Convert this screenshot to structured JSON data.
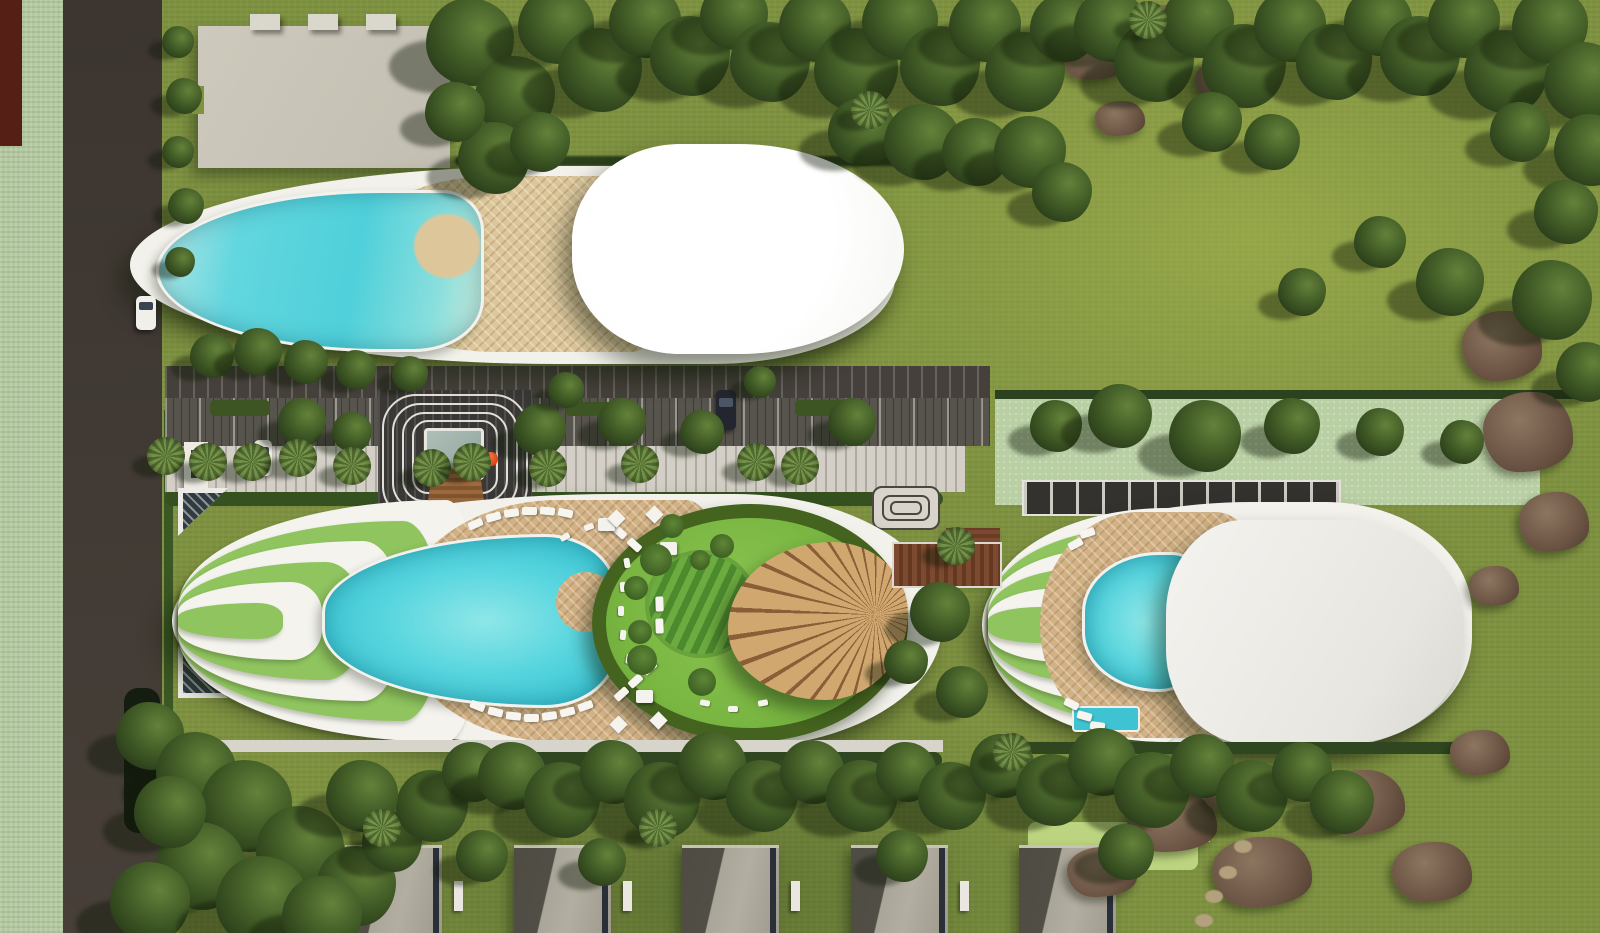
{
  "palette": {
    "lawn": "#7e9240",
    "lawn_light": "#9fae50",
    "paddock": "#b9cfa4",
    "greenbelt": "#b4c9a1",
    "road": "#3f3833",
    "maroon": "#551f16",
    "pool_water": "#4fd0da",
    "pool_deep": "#2aa9bd",
    "deck_wood": "#d2b184",
    "hull_white": "#f2f1eb",
    "roof_white": "#ffffff",
    "roof_gray": "#e9e8e3",
    "beige_building": "#c8c4b7",
    "villa_roof_light": "#aca89b",
    "villa_roof_dark": "#504d45",
    "tree_dark": "#2a3d1a",
    "terrace_green": "#8fc45f",
    "canopy_wood": "#c79a60",
    "accent_ball": "#e34e1f"
  },
  "landscape": {
    "trees": [
      [
        470,
        42,
        44
      ],
      [
        515,
        96,
        40
      ],
      [
        556,
        26,
        38
      ],
      [
        600,
        70,
        42
      ],
      [
        645,
        22,
        36
      ],
      [
        690,
        56,
        40
      ],
      [
        734,
        16,
        34
      ],
      [
        770,
        62,
        40
      ],
      [
        815,
        26,
        36
      ],
      [
        856,
        70,
        42
      ],
      [
        900,
        22,
        38
      ],
      [
        940,
        66,
        40
      ],
      [
        985,
        26,
        36
      ],
      [
        1025,
        72,
        40
      ],
      [
        1064,
        28,
        34
      ],
      [
        494,
        158,
        36
      ],
      [
        540,
        142,
        30
      ],
      [
        862,
        132,
        34
      ],
      [
        922,
        142,
        38
      ],
      [
        976,
        152,
        34
      ],
      [
        1030,
        152,
        36
      ],
      [
        1062,
        192,
        30
      ],
      [
        455,
        112,
        30
      ],
      [
        1110,
        26,
        36
      ],
      [
        1154,
        62,
        40
      ],
      [
        1198,
        22,
        36
      ],
      [
        1244,
        66,
        42
      ],
      [
        1290,
        26,
        36
      ],
      [
        1334,
        62,
        38
      ],
      [
        1378,
        22,
        34
      ],
      [
        1420,
        56,
        40
      ],
      [
        1464,
        22,
        36
      ],
      [
        1506,
        72,
        42
      ],
      [
        1550,
        26,
        38
      ],
      [
        1584,
        82,
        40
      ],
      [
        1590,
        150,
        36
      ],
      [
        1566,
        212,
        32
      ],
      [
        1520,
        132,
        30
      ],
      [
        1212,
        122,
        30
      ],
      [
        1272,
        142,
        28
      ],
      [
        1450,
        282,
        34
      ],
      [
        1552,
        300,
        40
      ],
      [
        1586,
        372,
        30
      ],
      [
        1380,
        242,
        26
      ],
      [
        1302,
        292,
        24
      ],
      [
        1056,
        426,
        26
      ],
      [
        1120,
        416,
        32
      ],
      [
        1205,
        436,
        36
      ],
      [
        1292,
        426,
        28
      ],
      [
        1380,
        432,
        24
      ],
      [
        1462,
        442,
        22
      ],
      [
        302,
        422,
        24
      ],
      [
        352,
        432,
        20
      ],
      [
        540,
        430,
        26
      ],
      [
        622,
        422,
        24
      ],
      [
        702,
        432,
        22
      ],
      [
        852,
        422,
        24
      ],
      [
        566,
        390,
        18
      ],
      [
        760,
        382,
        16
      ],
      [
        178,
        42,
        16
      ],
      [
        184,
        96,
        18
      ],
      [
        178,
        152,
        16
      ],
      [
        186,
        206,
        18
      ],
      [
        180,
        262,
        15
      ],
      [
        212,
        356,
        22
      ],
      [
        258,
        352,
        24
      ],
      [
        306,
        362,
        22
      ],
      [
        356,
        370,
        20
      ],
      [
        410,
        374,
        18
      ],
      [
        940,
        612,
        30
      ],
      [
        962,
        692,
        26
      ],
      [
        906,
        662,
        22
      ],
      [
        150,
        736,
        34
      ],
      [
        196,
        772,
        40
      ],
      [
        246,
        806,
        46
      ],
      [
        300,
        850,
        44
      ],
      [
        356,
        886,
        40
      ],
      [
        200,
        866,
        44
      ],
      [
        150,
        902,
        40
      ],
      [
        262,
        902,
        46
      ],
      [
        322,
        916,
        40
      ],
      [
        170,
        812,
        36
      ],
      [
        392,
        842,
        30
      ],
      [
        432,
        806,
        36
      ],
      [
        472,
        772,
        30
      ],
      [
        362,
        796,
        36
      ],
      [
        512,
        776,
        34
      ],
      [
        562,
        800,
        38
      ],
      [
        612,
        772,
        32
      ],
      [
        662,
        800,
        38
      ],
      [
        712,
        766,
        34
      ],
      [
        762,
        796,
        36
      ],
      [
        812,
        772,
        32
      ],
      [
        862,
        796,
        36
      ],
      [
        906,
        772,
        30
      ],
      [
        952,
        796,
        34
      ],
      [
        1002,
        766,
        32
      ],
      [
        1052,
        790,
        36
      ],
      [
        1102,
        762,
        34
      ],
      [
        1152,
        790,
        38
      ],
      [
        1202,
        766,
        32
      ],
      [
        1252,
        796,
        36
      ],
      [
        1302,
        772,
        30
      ],
      [
        1342,
        802,
        32
      ],
      [
        482,
        856,
        26
      ],
      [
        602,
        862,
        24
      ],
      [
        902,
        856,
        26
      ],
      [
        1126,
        852,
        28
      ]
    ],
    "palms": [
      [
        252,
        462
      ],
      [
        298,
        458
      ],
      [
        352,
        466
      ],
      [
        432,
        468
      ],
      [
        472,
        462
      ],
      [
        548,
        468
      ],
      [
        640,
        464
      ],
      [
        756,
        462
      ],
      [
        800,
        466
      ],
      [
        382,
        828
      ],
      [
        658,
        828
      ],
      [
        1012,
        752
      ],
      [
        956,
        546
      ],
      [
        166,
        456
      ],
      [
        208,
        462
      ],
      [
        1148,
        20
      ],
      [
        870,
        110
      ]
    ],
    "rocks": [
      [
        1095,
        55,
        70,
        50
      ],
      [
        1165,
        25,
        60,
        40
      ],
      [
        1230,
        80,
        70,
        45
      ],
      [
        1290,
        35,
        55,
        38
      ],
      [
        1120,
        118,
        50,
        35
      ],
      [
        1502,
        346,
        80,
        70
      ],
      [
        1528,
        432,
        90,
        80
      ],
      [
        1554,
        522,
        70,
        60
      ],
      [
        1494,
        586,
        50,
        40
      ],
      [
        1172,
        822,
        90,
        60
      ],
      [
        1262,
        872,
        100,
        70
      ],
      [
        1360,
        802,
        90,
        65
      ],
      [
        1432,
        872,
        80,
        60
      ],
      [
        1232,
        792,
        60,
        40
      ],
      [
        1102,
        872,
        70,
        50
      ],
      [
        1480,
        752,
        60,
        45
      ]
    ],
    "trail": [
      [
        1250,
        776
      ],
      [
        1240,
        808
      ],
      [
        1243,
        846
      ],
      [
        1228,
        872
      ],
      [
        1214,
        896
      ],
      [
        1204,
        920
      ]
    ],
    "villas": {
      "x_positions": [
        345,
        514,
        682,
        851,
        1019
      ],
      "width": 97,
      "height": 88,
      "top": 845
    }
  },
  "furniture": {
    "loungers_main_deck": [
      [
        468,
        520,
        -24
      ],
      [
        486,
        513,
        -16
      ],
      [
        504,
        509,
        -8
      ],
      [
        522,
        507,
        0
      ],
      [
        540,
        507,
        6
      ],
      [
        558,
        509,
        12
      ],
      [
        612,
        528,
        42
      ],
      [
        627,
        541,
        42
      ],
      [
        641,
        554,
        42
      ],
      [
        470,
        702,
        22
      ],
      [
        488,
        708,
        14
      ],
      [
        506,
        712,
        6
      ],
      [
        524,
        714,
        0
      ],
      [
        542,
        712,
        -8
      ],
      [
        560,
        708,
        -14
      ],
      [
        578,
        702,
        -20
      ],
      [
        614,
        690,
        -42
      ],
      [
        628,
        677,
        -42
      ],
      [
        642,
        664,
        -42
      ],
      [
        652,
        600,
        88
      ],
      [
        652,
        622,
        88
      ]
    ],
    "loungers_small_deck": [
      [
        1068,
        540,
        -28
      ],
      [
        1080,
        529,
        -18
      ],
      [
        1064,
        700,
        26
      ],
      [
        1077,
        712,
        16
      ],
      [
        1090,
        722,
        8
      ]
    ],
    "day_beds": [
      [
        598,
        518
      ],
      [
        660,
        542
      ],
      [
        636,
        690
      ]
    ],
    "garden_dots": [
      [
        622,
        560,
        80
      ],
      [
        618,
        584,
        85
      ],
      [
        616,
        608,
        90
      ],
      [
        618,
        632,
        95
      ],
      [
        624,
        656,
        100
      ],
      [
        700,
        700,
        10
      ],
      [
        728,
        706,
        0
      ],
      [
        758,
        700,
        -10
      ],
      [
        560,
        534,
        -30
      ],
      [
        584,
        524,
        -20
      ]
    ],
    "garden_bushes": [
      [
        656,
        560,
        16
      ],
      [
        642,
        660,
        15
      ],
      [
        702,
        682,
        14
      ],
      [
        672,
        526,
        12
      ],
      [
        722,
        546,
        12
      ],
      [
        636,
        588,
        12
      ],
      [
        640,
        632,
        12
      ],
      [
        700,
        560,
        10
      ]
    ],
    "garden_pavilions": [
      [
        610,
        512
      ],
      [
        648,
        508
      ],
      [
        612,
        718
      ],
      [
        652,
        714
      ]
    ]
  },
  "structures": {
    "parking_hedges": [
      [
        210,
        400,
        60,
        16
      ],
      [
        565,
        402,
        70,
        14
      ],
      [
        795,
        400,
        55,
        16
      ]
    ],
    "bow_band_count": 6
  }
}
